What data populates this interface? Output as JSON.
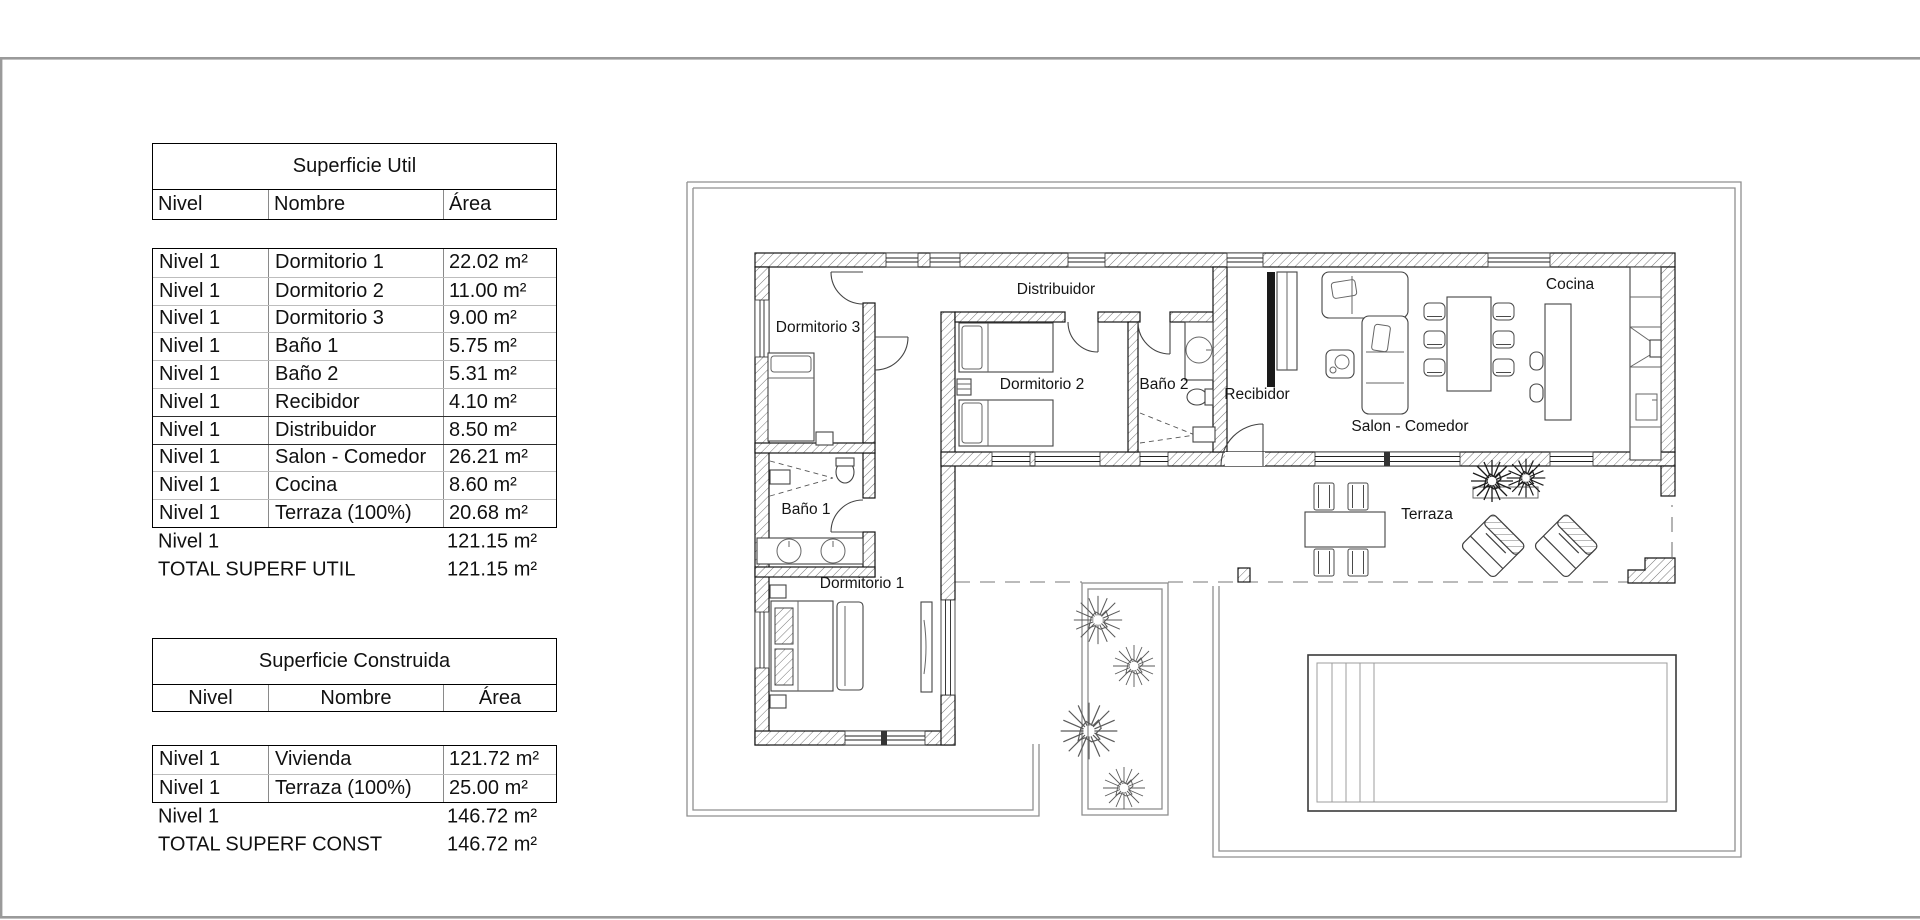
{
  "colors": {
    "wall_line": "#151515",
    "hatch": "#777777",
    "plot_line": "#8f8f8f",
    "frame": "#9a9a9a",
    "text": "#111111"
  },
  "tables": {
    "superficie_util": {
      "title": "Superficie Util",
      "columns": [
        "Nivel",
        "Nombre",
        "Área"
      ],
      "rows": [
        [
          "Nivel 1",
          "Dormitorio 1",
          "22.02 m²"
        ],
        [
          "Nivel 1",
          "Dormitorio 2",
          "11.00 m²"
        ],
        [
          "Nivel 1",
          "Dormitorio 3",
          "9.00 m²"
        ],
        [
          "Nivel 1",
          "Baño 1",
          "5.75 m²"
        ],
        [
          "Nivel 1",
          "Baño 2",
          "5.31 m²"
        ],
        [
          "Nivel 1",
          "Recibidor",
          "4.10 m²"
        ],
        [
          "Nivel 1",
          "Distribuidor",
          "8.50 m²"
        ],
        [
          "Nivel 1",
          "Salon - Comedor",
          "26.21 m²"
        ],
        [
          "Nivel 1",
          "Cocina",
          "8.60 m²"
        ],
        [
          "Nivel 1",
          "Terraza (100%)",
          "20.68 m²"
        ]
      ],
      "subtotal": {
        "label": "Nivel 1",
        "value": "121.15 m²"
      },
      "total": {
        "label": "TOTAL SUPERF UTIL",
        "value": "121.15 m²"
      }
    },
    "superficie_construida": {
      "title": "Superficie Construida",
      "columns": [
        "Nivel",
        "Nombre",
        "Área"
      ],
      "rows": [
        [
          "Nivel 1",
          "Vivienda",
          "121.72 m²"
        ],
        [
          "Nivel 1",
          "Terraza (100%)",
          "25.00 m²"
        ]
      ],
      "subtotal": {
        "label": "Nivel 1",
        "value": "146.72 m²"
      },
      "total": {
        "label": "TOTAL SUPERF CONST",
        "value": "146.72 m²"
      }
    }
  },
  "floor_plan": {
    "room_labels": [
      {
        "id": "dormitorio-3",
        "text": "Dormitorio 3",
        "x": 818,
        "y": 332
      },
      {
        "id": "distribuidor",
        "text": "Distribuidor",
        "x": 1056,
        "y": 294
      },
      {
        "id": "dormitorio-2",
        "text": "Dormitorio 2",
        "x": 1042,
        "y": 389
      },
      {
        "id": "bano-2",
        "text": "Baño 2",
        "x": 1164,
        "y": 389
      },
      {
        "id": "recibidor",
        "text": "Recibidor",
        "x": 1257,
        "y": 399
      },
      {
        "id": "cocina",
        "text": "Cocina",
        "x": 1570,
        "y": 289
      },
      {
        "id": "salon-comedor",
        "text": "Salon - Comedor",
        "x": 1410,
        "y": 431
      },
      {
        "id": "bano-1",
        "text": "Baño 1",
        "x": 806,
        "y": 514
      },
      {
        "id": "dormitorio-1",
        "text": "Dormitorio 1",
        "x": 862,
        "y": 588
      },
      {
        "id": "terraza",
        "text": "Terraza",
        "x": 1427,
        "y": 519
      }
    ]
  }
}
